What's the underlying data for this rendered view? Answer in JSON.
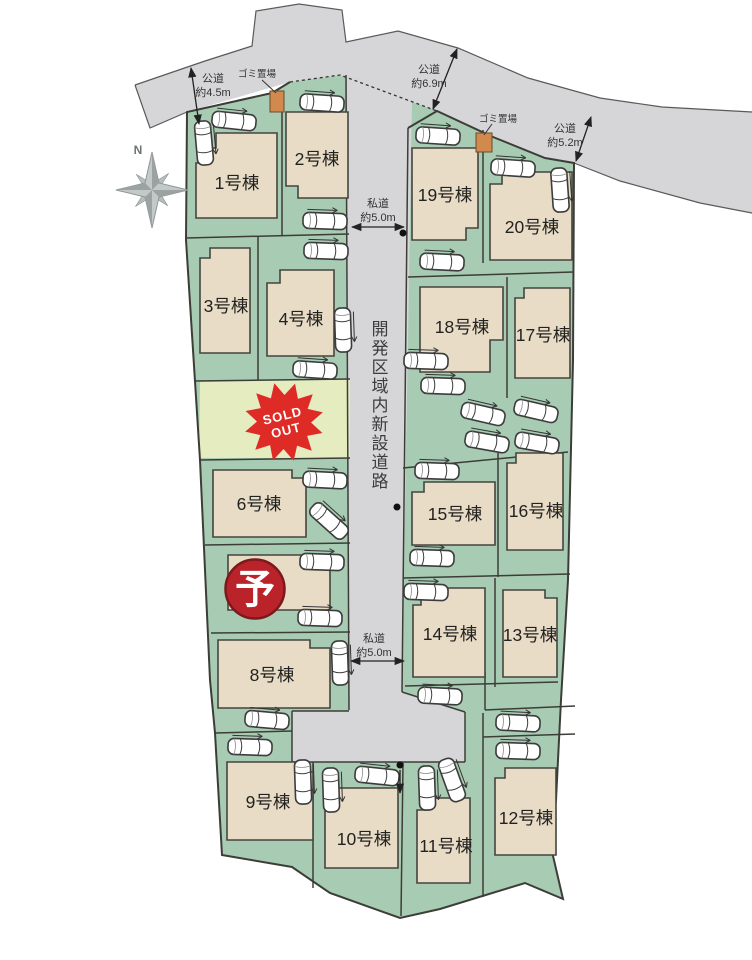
{
  "compass": {
    "north": "N"
  },
  "center_road": {
    "label": "開発区域内新設道路"
  },
  "dimensions": {
    "koudou_45": {
      "l1": "公道",
      "l2": "約4.5m"
    },
    "koudou_69": {
      "l1": "公道",
      "l2": "約6.9m"
    },
    "koudou_52": {
      "l1": "公道",
      "l2": "約5.2m"
    },
    "shidou_top": {
      "l1": "私道",
      "l2": "約5.0m"
    },
    "shidou_mid": {
      "l1": "私道",
      "l2": "約5.0m"
    }
  },
  "trash_sites": [
    {
      "label": "ゴミ置場"
    },
    {
      "label": "ゴミ置場"
    }
  ],
  "markers": {
    "sold_out": {
      "l1": "SOLD",
      "l2": "OUT"
    },
    "reserved": "予"
  },
  "lots": [
    {
      "label": "1号棟"
    },
    {
      "label": "2号棟"
    },
    {
      "label": "3号棟"
    },
    {
      "label": "4号棟"
    },
    {
      "label": "6号棟"
    },
    {
      "label": "8号棟"
    },
    {
      "label": "9号棟"
    },
    {
      "label": "10号棟"
    },
    {
      "label": "11号棟"
    },
    {
      "label": "12号棟"
    },
    {
      "label": "13号棟"
    },
    {
      "label": "14号棟"
    },
    {
      "label": "15号棟"
    },
    {
      "label": "16号棟"
    },
    {
      "label": "17号棟"
    },
    {
      "label": "18号棟"
    },
    {
      "label": "19号棟"
    },
    {
      "label": "20号棟"
    }
  ],
  "colors": {
    "site_green": "#a8cbb3",
    "road_gray": "#d6d6d8",
    "house_beige": "#e8dcc6",
    "sold_lot_yellow": "#e4ecc0",
    "sold_red": "#df2b26",
    "reserved_red": "#b92329",
    "trash_orange": "#d2894e"
  }
}
